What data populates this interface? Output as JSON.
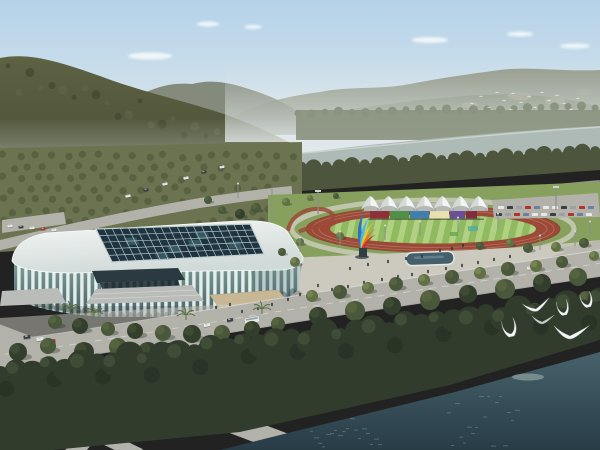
{
  "scene": {
    "description": "Aerial architectural rendering: white lattice-facade stadium with dark glass skylight roof, athletics track with white event tents and rainbow sculpture, plaza with reflecting pool, forested hills behind a river, boulevard with cars, dense shoreline forest and dark teal river with white gulls in front."
  },
  "colors": {
    "sky_top": "#b5d2e9",
    "sky_mid": "#cfe0ea",
    "sky_horizon": "#e4eaec",
    "cloud": "#ffffff",
    "haze": "#e3e9e9",
    "hill_left_dark": "#4c5036",
    "hill_left_mid": "#5d6243",
    "hill_far_left": "#7b8270",
    "mountain_right": "#7f8a73",
    "mountain_right_far": "#949b8b",
    "mountain_patch": "#aaa991",
    "distant_trees": "#8a9480",
    "river": "#aebab6",
    "river_light": "#cdd6d0",
    "bank_trees": "#4d553d",
    "orchard_base": "#6b7350",
    "orchard_dot": "#555e3d",
    "lawn": "#87a05e",
    "lawn_light": "#98b06b",
    "track": "#9c4a37",
    "field_green": "#8fba5f",
    "field_stripe": "#b7d789",
    "tent_white": "#f3f5f3",
    "tent_shade": "#c9cfcb",
    "plaza": "#ccc9bf",
    "plaza_light": "#d9d6cc",
    "pool": "#44606c",
    "pool_rim": "#e8e6dd",
    "road": "#b2b2ab",
    "road_dark": "#9d9d97",
    "road_line": "#dcdcd6",
    "stadium_rim": "#f6f8f7",
    "roof_shade": "#d0dad8",
    "skylight_dark": "#1e3440",
    "skylight_cell2": "#49767d",
    "mullion": "#c2cfcf",
    "glass_teal": "#7fa69c",
    "glass_dark": "#47636a",
    "fin_white": "#eef2f0",
    "entrance_dark": "#2a3a40",
    "steps": "#b9bcb8",
    "ramp_tan": "#c8b795",
    "tree_dark": "#333f2c",
    "tree_mid": "#49573a",
    "tree_light": "#5f7044",
    "tree_highlight": "#87985c",
    "shore_trees": "#313c2d",
    "shore_trees_light": "#4a573c",
    "water_top": "#47626c",
    "water_bottom": "#263a44",
    "water_light": "#8fa3a0",
    "gull_white": "#f5f7f7",
    "gull_gray": "#c9ccc8",
    "car_white": "#e8e8e8",
    "car_red": "#b33327",
    "car_dark": "#3a3f46",
    "car_teal": "#4e8d86",
    "person": "#2e3338",
    "pole": "#8a8f8c",
    "pedestal": "#2f3d45"
  },
  "objects": {
    "tents": {
      "x_start": 362,
      "spacing": 18,
      "count": 7,
      "peak_y": 196
    },
    "stand_panels": {
      "x": 370,
      "y": 211,
      "height": 7.5,
      "widths": [
        20,
        20,
        20,
        20,
        16,
        12
      ],
      "colors": [
        "#8f3038",
        "#4f8f46",
        "#3f7fae",
        "#e8e0b0",
        "#6a4f96",
        "#7e2f3a"
      ]
    },
    "sculpture_blades": [
      "#2e6fc4",
      "#49b8e0",
      "#e9c832",
      "#e07a1f",
      "#c8312b"
    ],
    "clouds": [
      [
        150,
        56,
        44,
        7
      ],
      [
        208,
        24,
        22,
        5
      ],
      [
        253,
        27,
        18,
        4
      ],
      [
        430,
        40,
        36,
        6
      ],
      [
        520,
        34,
        26,
        5
      ],
      [
        575,
        46,
        30,
        5
      ]
    ],
    "trees": [
      [
        55,
        322,
        7,
        "mid"
      ],
      [
        80,
        326,
        8,
        "dark"
      ],
      [
        108,
        329,
        7,
        "mid"
      ],
      [
        135,
        331,
        8,
        "dark"
      ],
      [
        163,
        333,
        8,
        "mid"
      ],
      [
        192,
        334,
        9,
        "dark"
      ],
      [
        222,
        333,
        8,
        "mid"
      ],
      [
        252,
        329,
        8,
        "dark"
      ],
      [
        278,
        324,
        7,
        "mid"
      ],
      [
        312,
        296,
        6,
        "light"
      ],
      [
        340,
        292,
        7,
        "mid"
      ],
      [
        368,
        288,
        6,
        "light"
      ],
      [
        396,
        284,
        7,
        "mid"
      ],
      [
        424,
        280,
        6,
        "light"
      ],
      [
        452,
        277,
        7,
        "mid"
      ],
      [
        480,
        273,
        6,
        "light"
      ],
      [
        508,
        269,
        7,
        "mid"
      ],
      [
        536,
        266,
        6,
        "light"
      ],
      [
        562,
        262,
        6,
        "mid"
      ],
      [
        318,
        316,
        9,
        "dark"
      ],
      [
        355,
        311,
        10,
        "mid"
      ],
      [
        392,
        306,
        9,
        "dark"
      ],
      [
        430,
        300,
        10,
        "mid"
      ],
      [
        468,
        294,
        9,
        "dark"
      ],
      [
        505,
        289,
        10,
        "mid"
      ],
      [
        542,
        283,
        9,
        "dark"
      ],
      [
        578,
        277,
        9,
        "mid"
      ],
      [
        295,
        262,
        5,
        "light"
      ],
      [
        282,
        252,
        4,
        "mid"
      ],
      [
        300,
        242,
        4,
        "light"
      ],
      [
        528,
        248,
        5,
        "mid"
      ],
      [
        556,
        247,
        5,
        "light"
      ],
      [
        584,
        243,
        5,
        "mid"
      ],
      [
        594,
        256,
        5,
        "light"
      ],
      [
        510,
        243,
        4,
        "light"
      ],
      [
        340,
        236,
        4,
        "light"
      ],
      [
        256,
        208,
        5,
        "mid"
      ],
      [
        240,
        214,
        5,
        "dark"
      ],
      [
        222,
        210,
        4,
        "mid"
      ],
      [
        208,
        200,
        4,
        "mid"
      ],
      [
        286,
        202,
        4,
        "light"
      ],
      [
        310,
        198,
        3,
        "light"
      ],
      [
        336,
        196,
        3,
        "mid"
      ],
      [
        480,
        246,
        4,
        "mid"
      ],
      [
        18,
        352,
        9,
        "dark"
      ],
      [
        48,
        346,
        8,
        "mid"
      ],
      [
        84,
        352,
        10,
        "dark"
      ],
      [
        118,
        347,
        9,
        "mid"
      ],
      [
        148,
        352,
        10,
        "dark"
      ],
      [
        178,
        357,
        9,
        "mid"
      ],
      [
        205,
        350,
        8,
        "dark"
      ],
      [
        235,
        355,
        9,
        "mid"
      ],
      [
        258,
        362,
        10,
        "dark"
      ],
      [
        30,
        372,
        10,
        "mid"
      ],
      [
        65,
        378,
        11,
        "dark"
      ],
      [
        100,
        384,
        10,
        "mid"
      ],
      [
        135,
        380,
        9,
        "dark"
      ],
      [
        170,
        386,
        10,
        "mid"
      ],
      [
        205,
        382,
        9,
        "dark"
      ],
      [
        240,
        386,
        10,
        "mid"
      ],
      [
        270,
        380,
        9,
        "dark"
      ],
      [
        295,
        372,
        8,
        "mid"
      ],
      [
        320,
        366,
        8,
        "dark"
      ],
      [
        345,
        358,
        8,
        "mid"
      ],
      [
        398,
        340,
        8,
        "dark"
      ],
      [
        425,
        334,
        8,
        "mid"
      ],
      [
        452,
        328,
        8,
        "dark"
      ],
      [
        480,
        322,
        8,
        "mid"
      ],
      [
        508,
        316,
        8,
        "dark"
      ],
      [
        535,
        310,
        7,
        "mid"
      ],
      [
        562,
        304,
        7,
        "dark"
      ],
      [
        586,
        298,
        7,
        "mid"
      ]
    ],
    "palms": [
      [
        70,
        314
      ],
      [
        186,
        320
      ],
      [
        262,
        314
      ],
      [
        94,
        318
      ]
    ],
    "cars": [
      [
        27,
        337,
        -8,
        "car_dark",
        1
      ],
      [
        40,
        339,
        -8,
        "car_white",
        1
      ],
      [
        52,
        341,
        -8,
        "car_red",
        1
      ],
      [
        14,
        373,
        -35,
        "car_white",
        1
      ],
      [
        88,
        368,
        -35,
        "car_red",
        1
      ],
      [
        80,
        357,
        -35,
        "car_teal",
        0.9
      ],
      [
        150,
        356,
        -12,
        "car_white",
        1
      ],
      [
        230,
        320,
        -12,
        "car_dark",
        0.9
      ],
      [
        207,
        325,
        -12,
        "car_white",
        0.9
      ],
      [
        128,
        196,
        -10,
        "car_white",
        0.75
      ],
      [
        146,
        190,
        -10,
        "car_dark",
        0.75
      ],
      [
        165,
        184,
        -10,
        "car_white",
        0.75
      ],
      [
        186,
        178,
        -10,
        "car_white",
        0.75
      ],
      [
        204,
        172,
        -10,
        "car_dark",
        0.75
      ],
      [
        222,
        167,
        -10,
        "car_white",
        0.7
      ],
      [
        505,
        272,
        -8,
        "car_dark",
        0.85
      ],
      [
        530,
        268,
        -8,
        "car_white",
        0.85
      ],
      [
        10,
        226,
        -6,
        "car_white",
        0.7
      ],
      [
        21,
        227,
        -6,
        "car_dark",
        0.7
      ],
      [
        32,
        228,
        -6,
        "car_white",
        0.7
      ],
      [
        43,
        229,
        -6,
        "car_red",
        0.7
      ],
      [
        54,
        230,
        -6,
        "car_white",
        0.7
      ]
    ],
    "bus": {
      "x": 252,
      "y": 320,
      "rot": -10,
      "w": 15,
      "h": 6
    },
    "parking_rows": [
      {
        "x0": 498,
        "x1": 592,
        "y": 206,
        "step": 9
      },
      {
        "x0": 496,
        "x1": 594,
        "y": 213,
        "step": 9
      }
    ],
    "parking_palette": [
      "car_white",
      "car_dark",
      "#9aa0a6",
      "car_red",
      "#6b7f9e",
      "car_white"
    ],
    "people": [
      [
        318,
        287
      ],
      [
        332,
        291
      ],
      [
        348,
        288
      ],
      [
        364,
        284
      ],
      [
        382,
        281
      ],
      [
        398,
        278
      ],
      [
        412,
        276
      ],
      [
        428,
        273
      ],
      [
        300,
        296
      ],
      [
        288,
        301
      ],
      [
        272,
        306
      ],
      [
        350,
        270
      ],
      [
        368,
        266
      ],
      [
        388,
        263
      ],
      [
        406,
        260
      ],
      [
        422,
        258
      ],
      [
        446,
        270
      ],
      [
        462,
        267
      ],
      [
        478,
        264
      ],
      [
        494,
        261
      ],
      [
        510,
        258
      ],
      [
        258,
        310
      ],
      [
        242,
        313
      ],
      [
        440,
        252
      ],
      [
        452,
        250
      ],
      [
        463,
        247
      ],
      [
        230,
        306
      ],
      [
        216,
        309
      ]
    ],
    "gulls": [
      {
        "x": 511,
        "y": 334,
        "s": 1.3,
        "r": -12,
        "pose": "up",
        "c": "gull_white"
      },
      {
        "x": 536,
        "y": 309,
        "s": 1.1,
        "r": -6,
        "pose": "glide",
        "c": "gull_white"
      },
      {
        "x": 542,
        "y": 322,
        "s": 0.9,
        "r": 5,
        "pose": "glide",
        "c": "gull_gray"
      },
      {
        "x": 564,
        "y": 313,
        "s": 1.1,
        "r": -10,
        "pose": "up",
        "c": "gull_white"
      },
      {
        "x": 570,
        "y": 336,
        "s": 1.4,
        "r": 6,
        "pose": "glide",
        "c": "gull_white"
      },
      {
        "x": 588,
        "y": 305,
        "s": 1.1,
        "r": -14,
        "pose": "up",
        "c": "gull_white"
      }
    ],
    "flock": [
      [
        472,
        104
      ],
      [
        481,
        97
      ],
      [
        489,
        108
      ],
      [
        497,
        93
      ],
      [
        504,
        101
      ],
      [
        511,
        110
      ],
      [
        513,
        94
      ],
      [
        521,
        103
      ],
      [
        529,
        97
      ],
      [
        535,
        108
      ],
      [
        542,
        93
      ],
      [
        549,
        101
      ],
      [
        557,
        96
      ],
      [
        564,
        104
      ],
      [
        571,
        110
      ],
      [
        578,
        99
      ]
    ],
    "light_poles": [
      [
        300,
        252
      ],
      [
        340,
        246
      ],
      [
        385,
        240
      ],
      [
        420,
        236
      ],
      [
        458,
        232
      ],
      [
        498,
        228
      ],
      [
        540,
        250
      ],
      [
        575,
        246
      ],
      [
        238,
        198
      ],
      [
        590,
        236
      ]
    ],
    "floodlights": [
      [
        318,
        192
      ],
      [
        556,
        188
      ]
    ]
  }
}
